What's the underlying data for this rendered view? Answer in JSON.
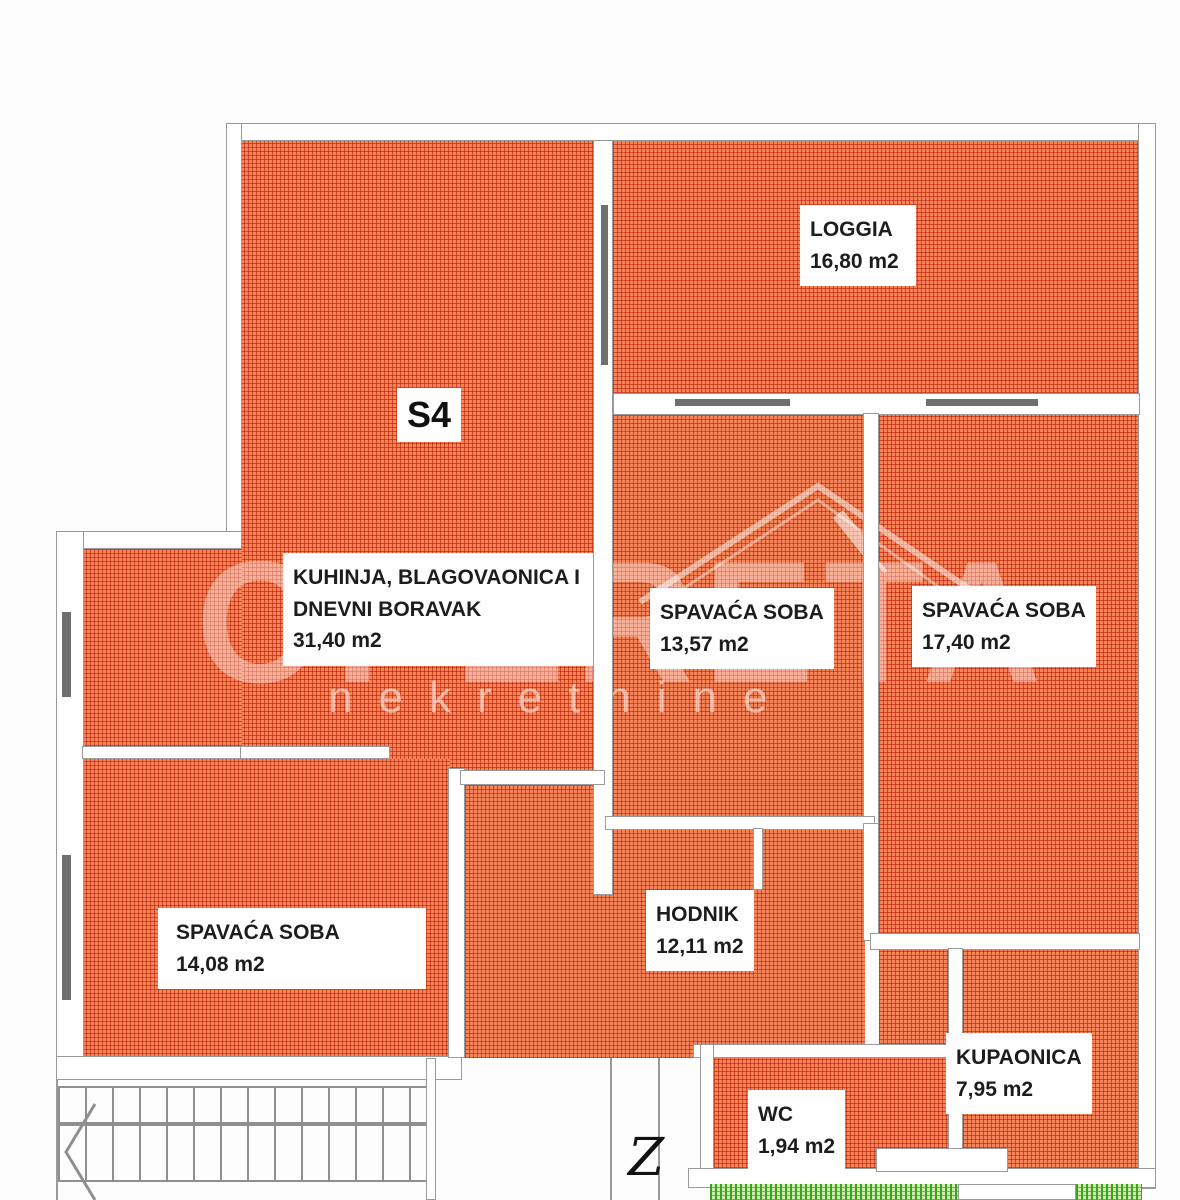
{
  "unit": {
    "label": "S4"
  },
  "compass": {
    "label": "Z"
  },
  "rooms": {
    "loggia": {
      "name": "LOGGIA",
      "area": "16,80 m2"
    },
    "kitchen": {
      "name_line1": "KUHINJA, BLAGOVAONICA I",
      "name_line2": "DNEVNI BORAVAK",
      "area": "31,40 m2"
    },
    "bedroom_top": {
      "name": "SPAVAĆA SOBA",
      "area": "13,57 m2"
    },
    "bedroom_right": {
      "name": "SPAVAĆA SOBA",
      "area": "17,40 m2"
    },
    "bedroom_left": {
      "name": "SPAVAĆA SOBA",
      "area": "14,08 m2"
    },
    "hallway": {
      "name": "HODNIK",
      "area": "12,11 m2"
    },
    "bathroom": {
      "name": "KUPAONICA",
      "area": "7,95 m2"
    },
    "wc": {
      "name": "WC",
      "area": "1,94 m2"
    }
  },
  "watermark": {
    "brand": "OPERETA",
    "subtitle": "nekretnine"
  },
  "colors": {
    "room_hatch": "#e8532c",
    "terrace_hatch": "#4caf2e",
    "wall_line": "#9a9a9a",
    "label_bg": "#fefefe",
    "label_text": "#1d1d1d"
  }
}
